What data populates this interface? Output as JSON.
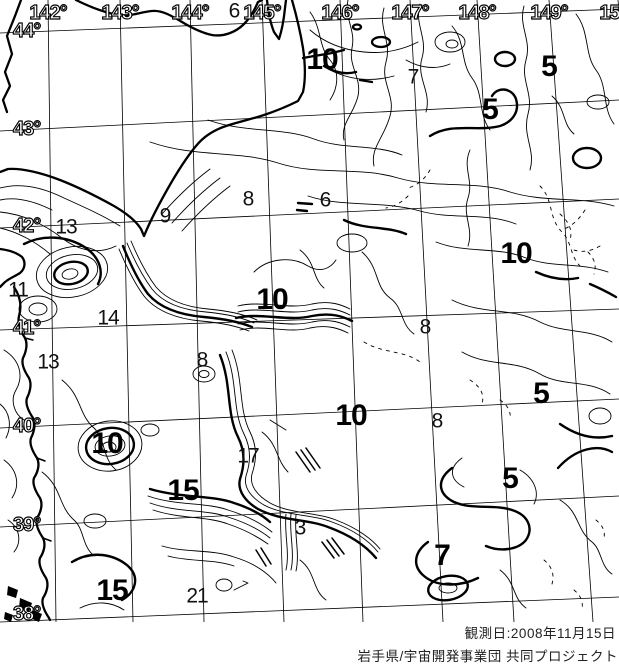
{
  "page": {
    "background": "#ffffff",
    "ink": "#000000"
  },
  "grid": {
    "bottom_y": 622,
    "right_x": 619,
    "longitude_lines": [
      {
        "label": "142°",
        "x_top": 48,
        "x_bottom": 56
      },
      {
        "label": "143°",
        "x_top": 120,
        "x_bottom": 133
      },
      {
        "label": "144°",
        "x_top": 190,
        "x_bottom": 204
      },
      {
        "label": "145°",
        "x_top": 262,
        "x_bottom": 284
      },
      {
        "label": "146°",
        "x_top": 340,
        "x_bottom": 363
      },
      {
        "label": "147°",
        "x_top": 410,
        "x_bottom": 443
      },
      {
        "label": "148°",
        "x_top": 477,
        "x_bottom": 514
      },
      {
        "label": "149°",
        "x_top": 549,
        "x_bottom": 593
      },
      {
        "label": "150°",
        "x_top": 618,
        "x_bottom": 668
      }
    ],
    "latitude_lines": [
      {
        "label": "44°",
        "y_left": 33,
        "y_right": 9
      },
      {
        "label": "43°",
        "y_left": 131,
        "y_right": 100
      },
      {
        "label": "42°",
        "y_left": 228,
        "y_right": 199
      },
      {
        "label": "41°",
        "y_left": 330,
        "y_right": 309
      },
      {
        "label": "40°",
        "y_left": 428,
        "y_right": 399
      },
      {
        "label": "39°",
        "y_left": 527,
        "y_right": 496
      },
      {
        "label": "38°",
        "y_left": 622,
        "y_right": 597
      }
    ]
  },
  "contour_labels": [
    {
      "value": "6",
      "x": 234,
      "y": 11,
      "size": "small"
    },
    {
      "value": "10",
      "x": 322,
      "y": 60,
      "size": "large"
    },
    {
      "value": "7",
      "x": 413,
      "y": 77,
      "size": "small"
    },
    {
      "value": "5",
      "x": 549,
      "y": 67,
      "size": "large"
    },
    {
      "value": "5",
      "x": 490,
      "y": 110,
      "size": "large"
    },
    {
      "value": "8",
      "x": 248,
      "y": 199,
      "size": "small"
    },
    {
      "value": "6",
      "x": 325,
      "y": 200,
      "size": "small"
    },
    {
      "value": "9",
      "x": 165,
      "y": 216,
      "size": "small"
    },
    {
      "value": "13",
      "x": 66,
      "y": 227,
      "size": "small"
    },
    {
      "value": "11",
      "x": 18,
      "y": 290,
      "size": "small"
    },
    {
      "value": "10",
      "x": 516,
      "y": 254,
      "size": "large"
    },
    {
      "value": "14",
      "x": 108,
      "y": 318,
      "size": "small"
    },
    {
      "value": "10",
      "x": 272,
      "y": 300,
      "size": "large"
    },
    {
      "value": "8",
      "x": 425,
      "y": 327,
      "size": "small"
    },
    {
      "value": "13",
      "x": 48,
      "y": 362,
      "size": "small"
    },
    {
      "value": "8",
      "x": 202,
      "y": 360,
      "size": "small"
    },
    {
      "value": "5",
      "x": 541,
      "y": 394,
      "size": "large"
    },
    {
      "value": "10",
      "x": 351,
      "y": 416,
      "size": "large"
    },
    {
      "value": "8",
      "x": 437,
      "y": 421,
      "size": "small"
    },
    {
      "value": "10",
      "x": 107,
      "y": 444,
      "size": "large"
    },
    {
      "value": "17",
      "x": 248,
      "y": 456,
      "size": "small"
    },
    {
      "value": "5",
      "x": 510,
      "y": 479,
      "size": "large"
    },
    {
      "value": "15",
      "x": 183,
      "y": 491,
      "size": "large"
    },
    {
      "value": "3",
      "x": 300,
      "y": 528,
      "size": "small"
    },
    {
      "value": "7",
      "x": 442,
      "y": 556,
      "size": "large"
    },
    {
      "value": "15",
      "x": 112,
      "y": 591,
      "size": "large"
    },
    {
      "value": "21",
      "x": 197,
      "y": 596,
      "size": "small"
    }
  ],
  "captions": {
    "observation_date": "観測日:2008年11月15日",
    "credit": "岩手県/宇宙開発事業団 共同プロジェクト"
  }
}
